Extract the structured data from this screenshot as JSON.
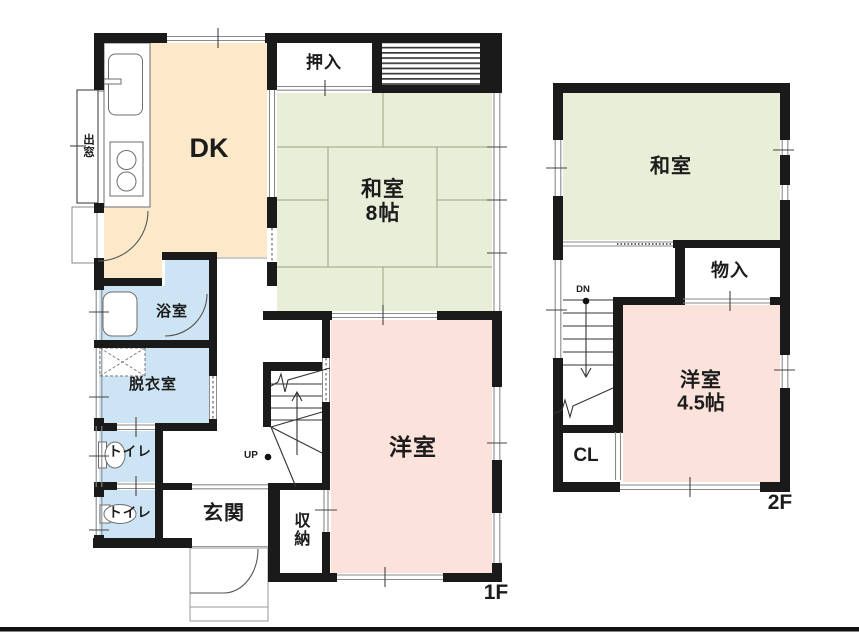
{
  "colors": {
    "wall": "#1a1a1a",
    "tatami-green": "#e9eed8",
    "room-pink": "#fbe2da",
    "water-blue": "#cde4f4",
    "kitchen-cream": "#fbe9c9",
    "line-gray": "#8a8a8a",
    "tatami-line": "#99a27e"
  },
  "floor1": {
    "floor_label": "1F",
    "rooms": {
      "dk": "DK",
      "washitsu": "和室",
      "washitsu_size": "8帖",
      "oshiire": "押入",
      "yokushitsu": "浴室",
      "datsuishitsu": "脱衣室",
      "toilet_upper": "トイレ",
      "toilet_lower": "トイレ",
      "genkan": "玄関",
      "shunou": "収納",
      "youshitsu": "洋室",
      "demado": "出窓",
      "stairs_up": "UP"
    }
  },
  "floor2": {
    "floor_label": "2F",
    "rooms": {
      "washitsu": "和室",
      "monoire": "物入",
      "youshitsu": "洋室",
      "youshitsu_size": "4.5帖",
      "closet": "CL",
      "stairs_down": "DN"
    }
  }
}
